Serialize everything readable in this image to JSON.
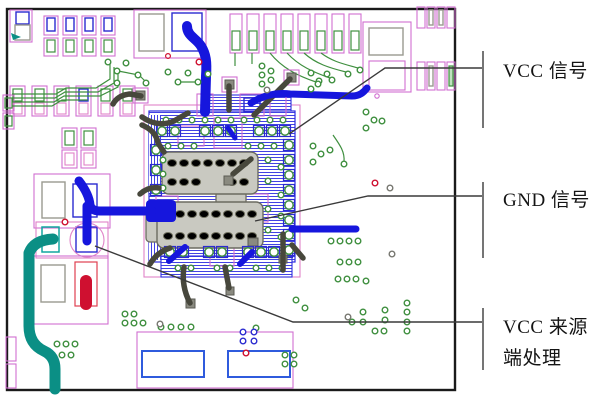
{
  "figure": {
    "annotations": {
      "items": [
        {
          "id": "vcc-signal",
          "label": "VCC 信号"
        },
        {
          "id": "gnd-signal",
          "label": "GND 信号"
        },
        {
          "id": "vcc-source",
          "label": "VCC 来源端处理",
          "lines": [
            "VCC 来源",
            "端处理"
          ]
        }
      ]
    },
    "colors": {
      "board_outline": "#1a1a1a",
      "trace_blue": "#1616dd",
      "trace_teal": "#0b8f85",
      "trace_red": "#cf1030",
      "trace_dark": "#47473c",
      "silkscreen_pink": "#d06ed0",
      "pad_green": "#3f8f3f",
      "pad_blue_outline": "#2b2bd0",
      "die_gray": "#c9c9c1",
      "leader_line": "#3a3a3a",
      "box_blue": "#2f5bdd"
    }
  }
}
